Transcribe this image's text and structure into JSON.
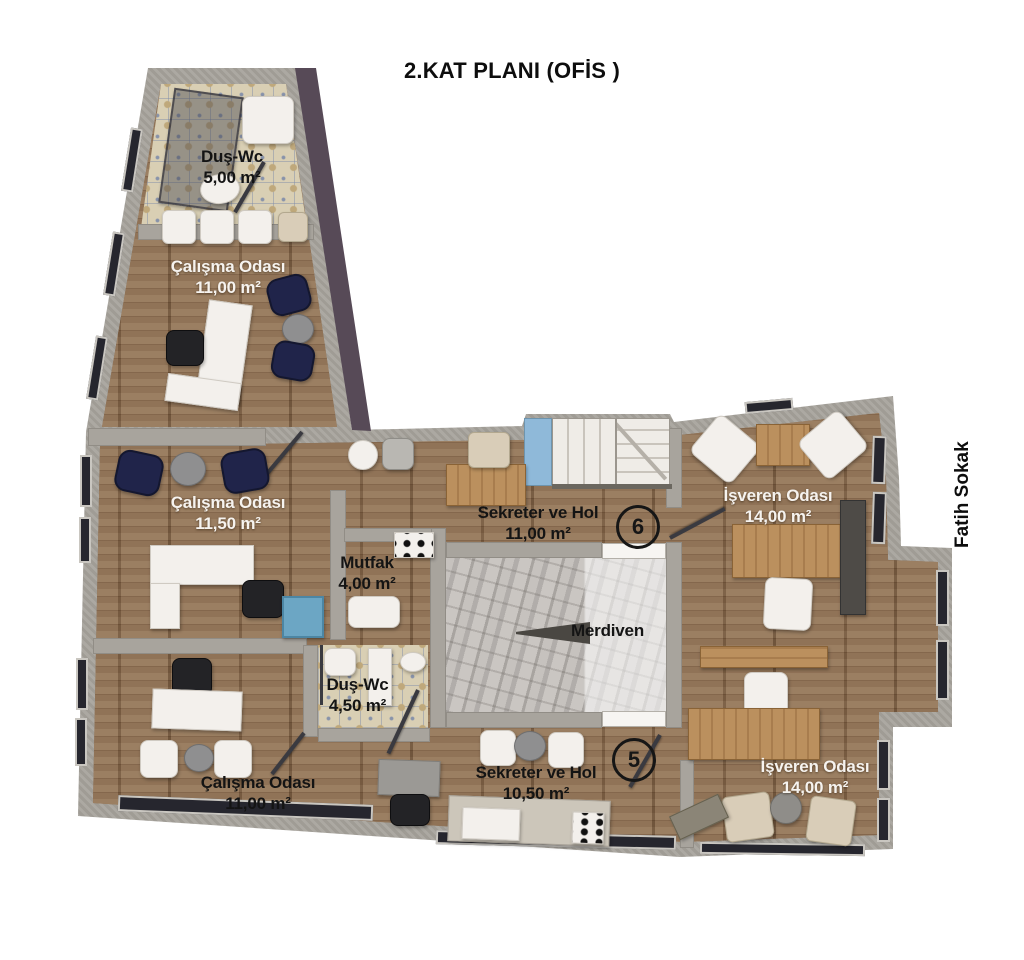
{
  "title": "2.KAT PLANI (OFİS )",
  "street_label": "Fatih Sokak",
  "rooms": {
    "dus_wc_top": {
      "name": "Duş-Wc",
      "area": "5,00 m²"
    },
    "calisma_top": {
      "name": "Çalışma Odası",
      "area": "11,00 m²"
    },
    "calisma_mid": {
      "name": "Çalışma Odası",
      "area": "11,50 m²"
    },
    "mutfak": {
      "name": "Mutfak",
      "area": "4,00 m²"
    },
    "sekreter_top": {
      "name": "Sekreter ve Hol",
      "area": "11,00 m²",
      "badge": "6"
    },
    "isveren_top": {
      "name": "İşveren Odası",
      "area": "14,00 m²"
    },
    "merdiven": {
      "name": "Merdiven"
    },
    "dus_wc_mid": {
      "name": "Duş-Wc",
      "area": "4,50 m²"
    },
    "calisma_bottom": {
      "name": "Çalışma Odası",
      "area": "11,00 m²"
    },
    "sekreter_bottom": {
      "name": "Sekreter ve Hol",
      "area": "10,50 m²",
      "badge": "5"
    },
    "isveren_bottom": {
      "name": "İşveren Odası",
      "area": "14,00 m²"
    }
  },
  "colors": {
    "wall": "#a8a49d",
    "purple_edge": "#574a57",
    "wood_floor": "#87684c",
    "bath_tile": "#d9cfb4",
    "marble": "#bfbbb7",
    "stair_landing_blue": "#8fb9d9",
    "navy_chair": "#20244a",
    "label_white": "#f6f3ef",
    "label_black": "#141414"
  }
}
